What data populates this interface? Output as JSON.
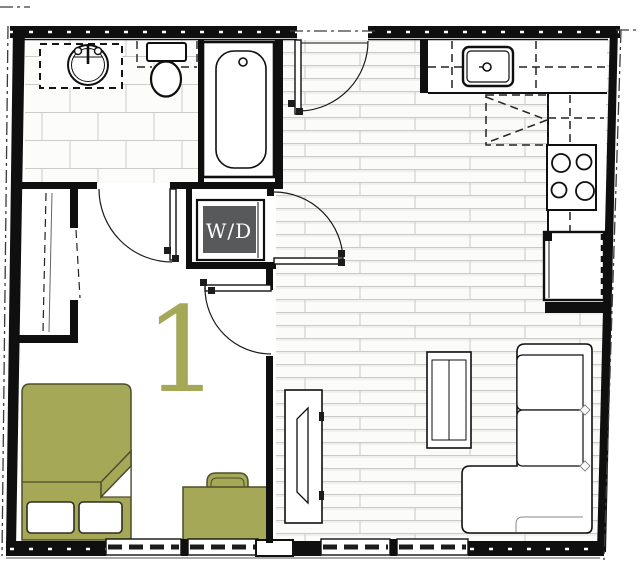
{
  "unit": {
    "number": "1"
  },
  "labels": {
    "washer_dryer": "W/D"
  },
  "colors": {
    "accent": "#a4a857",
    "accent-dark": "#4c4e2a",
    "wall": "#0f0f0f",
    "wd-box": "#58595b",
    "wd-text": "#ffffff",
    "floor-line": "#c9c9c6",
    "dash": "#3a3a3a"
  },
  "fixtures": [
    "bathtub",
    "toilet",
    "vanity-sink",
    "washer-dryer",
    "closet",
    "kitchen-sink",
    "upper-cabinets",
    "stove",
    "refrigerator",
    "bed",
    "pillows",
    "desk",
    "desk-chair",
    "sofa-sectional",
    "coffee-table",
    "tv-console",
    "entry-door",
    "bathroom-door",
    "bedroom-door",
    "laundry-door",
    "windows",
    "property-line"
  ]
}
